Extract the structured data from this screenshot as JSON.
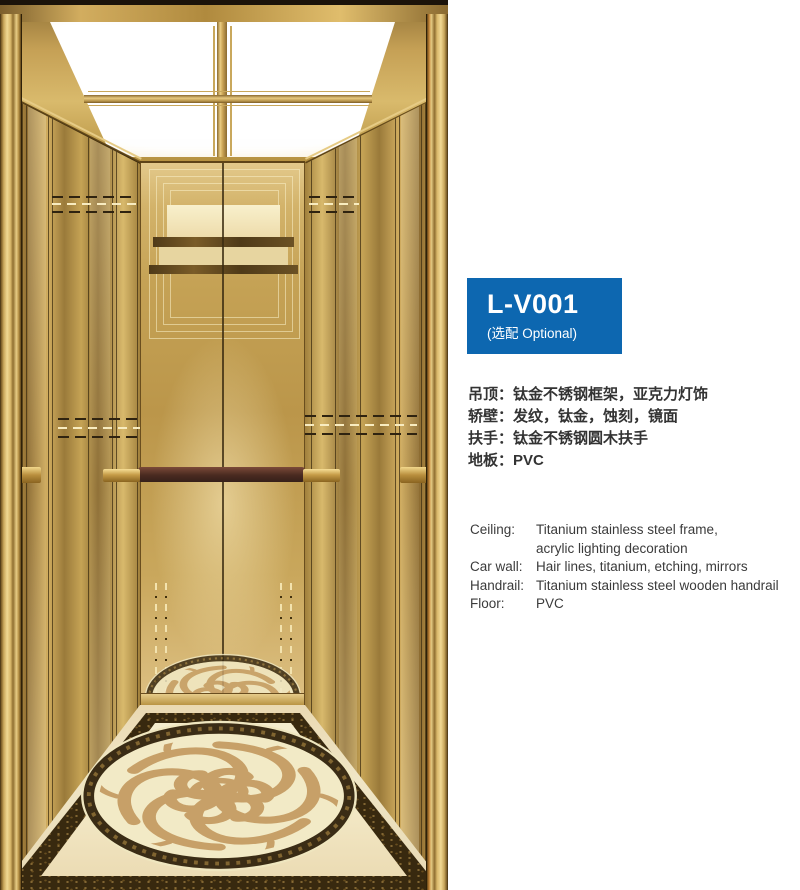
{
  "product": {
    "model": "L-V001",
    "optional_note": "(选配 Optional)"
  },
  "specs_cn": {
    "lines": [
      "吊顶：钛金不锈钢框架，亚克力灯饰",
      "轿壁：发纹，钛金，蚀刻，镜面",
      "扶手：钛金不锈钢圆木扶手",
      "地板：PVC"
    ]
  },
  "specs_en": {
    "rows": [
      {
        "label": "Ceiling:",
        "value": "Titanium stainless steel frame,",
        "value2": "acrylic lighting decoration"
      },
      {
        "label": "Car wall:",
        "value": "Hair lines, titanium, etching, mirrors"
      },
      {
        "label": "Handrail:",
        "value": "Titanium stainless steel wooden handrail"
      },
      {
        "label": "Floor:",
        "value": "PVC"
      }
    ]
  },
  "illustration": {
    "subject": "elevator-car-interior-rendering",
    "colors": {
      "badge_blue": "#0d67b0",
      "wall_gold": "#c5a355",
      "ceiling_light_white": "#ffffff",
      "handrail_wood": "#4a2a20",
      "floor_cream": "#f0e6c6",
      "floor_border_dark": "#38290f",
      "medallion_swirl_tan": "#c59c64"
    }
  }
}
